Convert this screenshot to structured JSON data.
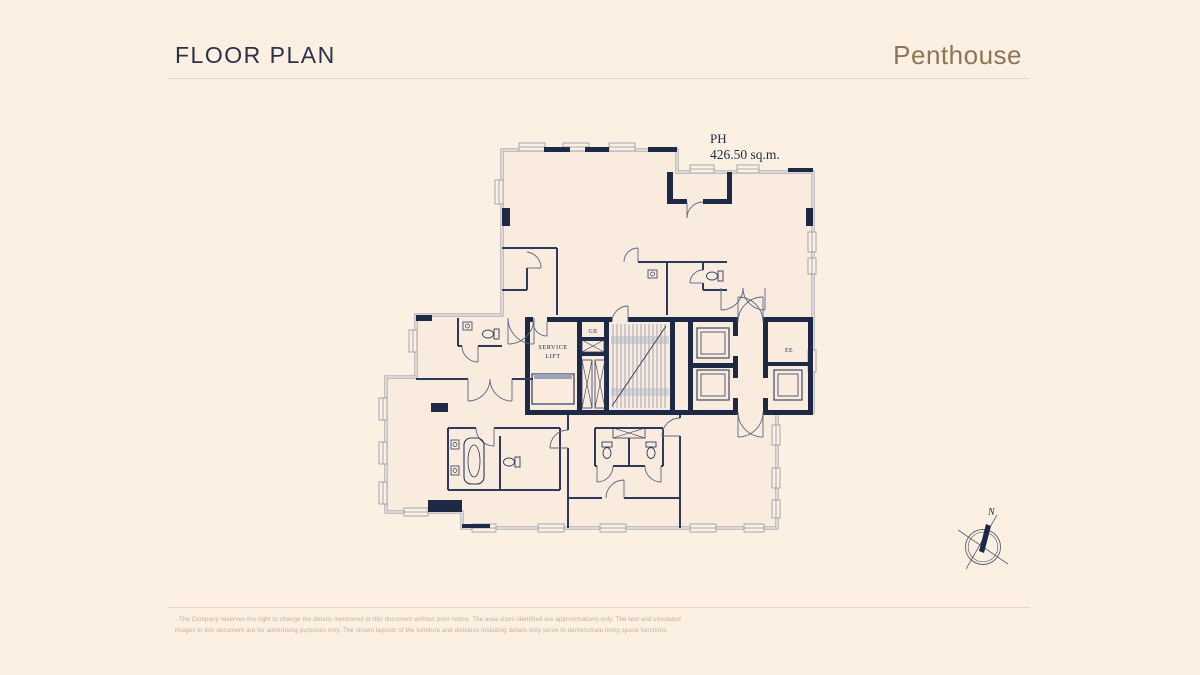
{
  "page": {
    "background": "#fcf0e2"
  },
  "header": {
    "title": "FLOOR PLAN",
    "subtitle": "Penthouse",
    "title_color": "#2a3149",
    "subtitle_color": "#8f7457"
  },
  "plan": {
    "unit_label": "PH",
    "unit_area": "426.50 sq.m.",
    "wall_color": "#1e2946",
    "interior_color": "#f9ecdf",
    "labels": {
      "service_lift_line1": "SERVICE",
      "service_lift_line2": "LIFT",
      "gb": "GB",
      "ee": "EE"
    }
  },
  "compass": {
    "north_label": "N"
  },
  "footer": {
    "disclaimer_line1": "- The Company reserves the right to change the details mentioned in this document without prior notice. The area sizes identified are approximations only. The text and simulated",
    "disclaimer_line2": "images in this document are for advertising purposes only. The shown layouts of the furniture and divisions including details only serve to demonstrate living space functions."
  }
}
